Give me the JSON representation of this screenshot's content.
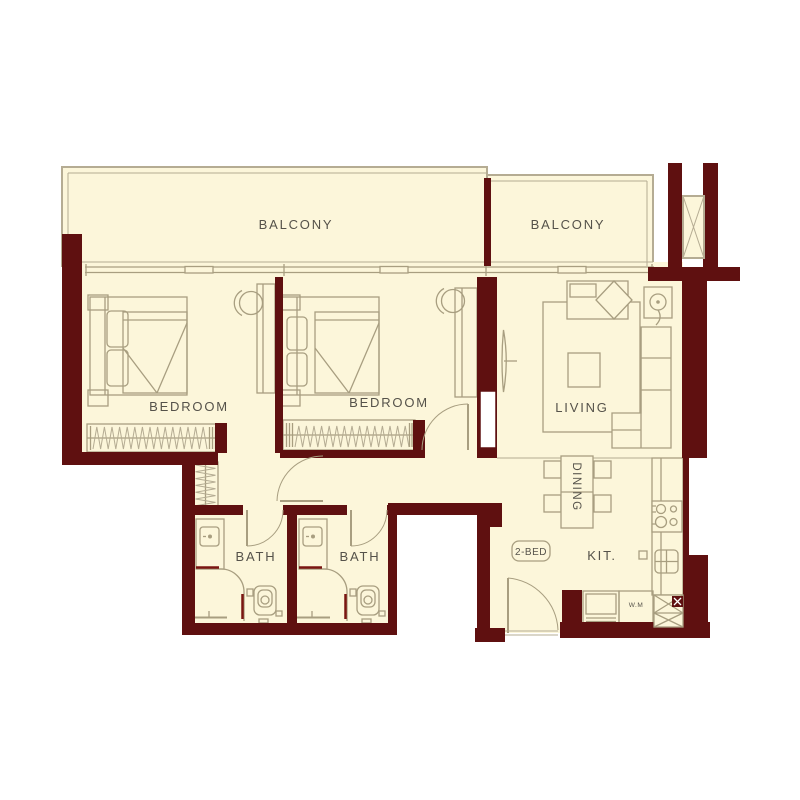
{
  "plan": {
    "unit_type_label": "2-BED",
    "rooms": {
      "balcony_1": "BALCONY",
      "balcony_2": "BALCONY",
      "bedroom_1": "BEDROOM",
      "bedroom_2": "BEDROOM",
      "living": "LIVING",
      "dining": "DINING",
      "kitchen": "KIT.",
      "bath_1": "BATH",
      "bath_2": "BATH",
      "washing_machine": "W.M"
    },
    "colors": {
      "wall": "#5f1010",
      "floor": "#fcf6da",
      "furniture_line": "#a89e80",
      "railing_line": "#b5ac93",
      "accent": "#7a1511",
      "text": "#55524a",
      "background": "#ffffff"
    }
  }
}
